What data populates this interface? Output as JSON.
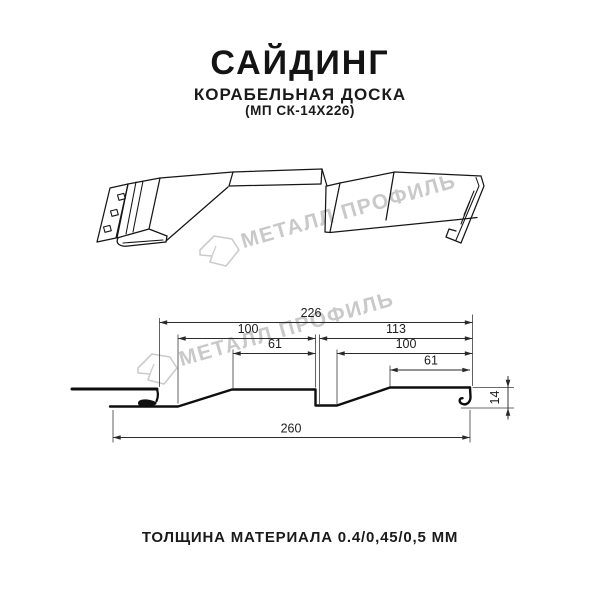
{
  "header": {
    "title": "САЙДИНГ",
    "subtitle": "КОРАБЕЛЬНАЯ ДОСКА",
    "product_code": "(МП СК-14Х226)"
  },
  "watermark": {
    "brand": "МЕТАЛЛ ПРОФИЛЬ",
    "color": "#c9c9c9"
  },
  "footer": {
    "thickness_label": "ТОЛЩИНА МАТЕРИАЛА 0.4/0,45/0,5 ММ"
  },
  "drawing": {
    "type": "technical profile drawing, 3d sketch above dimensioned cross-section",
    "colors": {
      "line": "#161616",
      "dimension": "#2a2a2a",
      "text": "#1c1c1c"
    },
    "dims": {
      "d226": "226",
      "d100L": "100",
      "d113": "113",
      "d61L": "61",
      "d100R": "100",
      "d61R": "61",
      "d260": "260",
      "d14": "14"
    }
  }
}
